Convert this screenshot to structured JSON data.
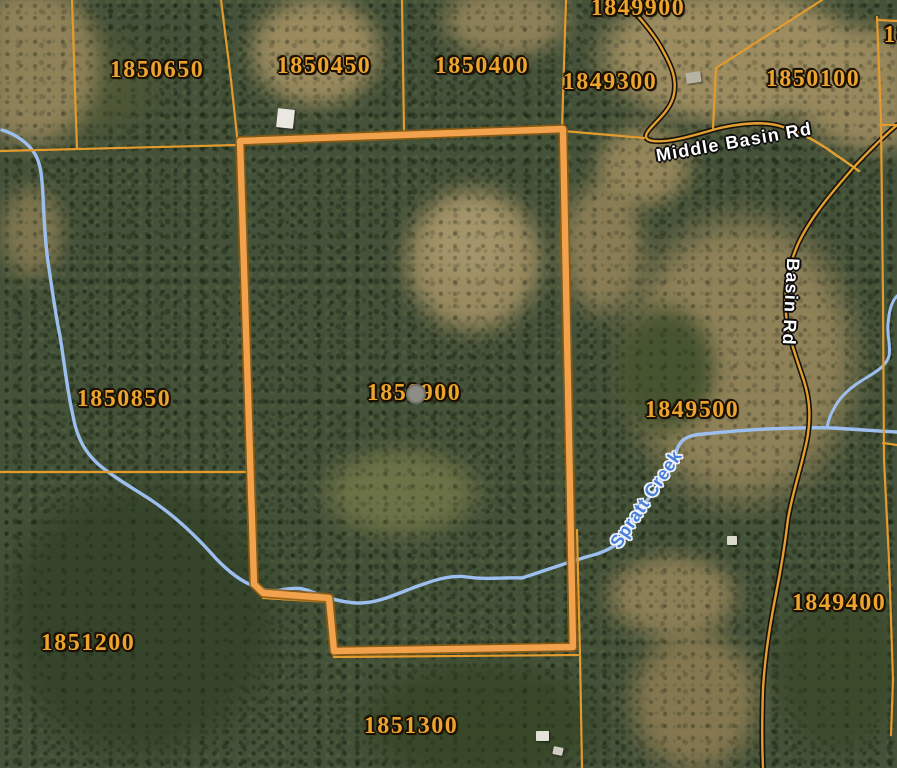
{
  "map": {
    "description": "County GIS parcel viewer - aerial imagery with parcel overlay",
    "selected_parcel_id": "1850900",
    "colors": {
      "parcel_line": "#e39b2d",
      "selected_outline": "#8d5d13",
      "selected_line": "#f2a14d",
      "road_casing": "#17130a",
      "road_center": "#e49f33",
      "creek": "#9dbff0",
      "parcel_text": "#eca42e",
      "road_text": "#ffffff",
      "creek_text": "#4a7fd8"
    },
    "selected_marker": {
      "x": 415,
      "y": 393,
      "r": 9
    },
    "parcel_labels": [
      {
        "text": "1849900",
        "x": 638,
        "y": 8
      },
      {
        "text": "1850650",
        "x": 157,
        "y": 70
      },
      {
        "text": "1850450",
        "x": 324,
        "y": 66
      },
      {
        "text": "1850400",
        "x": 482,
        "y": 66
      },
      {
        "text": "1849300",
        "x": 610,
        "y": 82
      },
      {
        "text": "1850100",
        "x": 813,
        "y": 79
      },
      {
        "text": "18",
        "x": 897,
        "y": 35
      },
      {
        "text": "1850850",
        "x": 124,
        "y": 399
      },
      {
        "text": "1850900",
        "x": 414,
        "y": 393
      },
      {
        "text": "1849500",
        "x": 692,
        "y": 410
      },
      {
        "text": "1849400",
        "x": 839,
        "y": 603
      },
      {
        "text": "1851200",
        "x": 88,
        "y": 643
      },
      {
        "text": "1851300",
        "x": 411,
        "y": 726
      }
    ],
    "road_labels": [
      {
        "text": "Middle Basin Rd",
        "x": 734,
        "y": 142,
        "rotate": -10
      },
      {
        "text": "Basin Rd",
        "x": 791,
        "y": 302,
        "rotate": 93
      }
    ],
    "water_labels": [
      {
        "text": "Spratt Creek",
        "x": 646,
        "y": 499,
        "rotate": -56
      }
    ],
    "structures": [
      {
        "x": 277,
        "y": 109,
        "w": 17,
        "h": 19,
        "rotate": 6,
        "color": "#e9e7df"
      },
      {
        "x": 686,
        "y": 72,
        "w": 15,
        "h": 11,
        "rotate": -8,
        "color": "#b8b2a2"
      },
      {
        "x": 536,
        "y": 731,
        "w": 13,
        "h": 10,
        "rotate": 0,
        "color": "#e4e2d8"
      },
      {
        "x": 553,
        "y": 747,
        "w": 10,
        "h": 8,
        "rotate": 12,
        "color": "#cfccc0"
      },
      {
        "x": 727,
        "y": 536,
        "w": 10,
        "h": 9,
        "rotate": 0,
        "color": "#dcd9cd"
      }
    ],
    "vectors": [
      {
        "name": "creek-spratt-main",
        "stroke": "creek",
        "width": 3.4,
        "d": "M 2,130 C 16,134 29,144 35,154 C 41,164 42,178 43,196 C 44,220 45,240 48,262 C 52,288 55,312 60,336 C 64,360 67,390 73,416 C 77,438 85,452 98,464 C 112,476 131,487 151,500 C 172,514 191,531 211,553 C 224,568 238,579 249,584 C 259,589 270,592 281,590 C 293,588 301,587 312,592 C 327,598 341,602 356,603 C 380,604 402,591 421,585 C 437,579 452,575 467,577 C 487,580 506,577 522,578 C 537,573 549,569 561,565 C 573,561 585,557 597,554 C 608,550 618,545 622,538 C 627,530 633,516 642,507 C 652,494 661,482 668,472 C 673,464 675,455 678,447 C 682,438 690,435 703,434 C 723,432 744,430 766,429 C 790,428 813,427 832,428 C 852,429 876,431 897,432"
      },
      {
        "name": "creek-tributary",
        "stroke": "creek",
        "width": 3,
        "d": "M 897,296 C 891,302 889,312 888,324 C 887,337 891,346 889,356 C 886,366 877,371 866,378 C 852,386 842,395 836,405 C 831,413 828,420 827,428"
      },
      {
        "name": "road-middle-basin-casing",
        "stroke": "road_casing",
        "width": 5.6,
        "d": "M 628,5 C 641,19 654,34 662,49 C 671,65 677,78 674,94 C 671,110 657,120 649,130 C 644,136 645,140 653,141 C 668,143 692,136 716,129 C 741,123 766,121 783,127 C 790,129 797,132 803,135"
      },
      {
        "name": "road-basin-casing",
        "stroke": "road_casing",
        "width": 5.6,
        "d": "M 897,125 C 884,136 869,151 854,167 C 837,187 812,214 798,244 C 788,267 784,291 786,314 C 788,337 797,359 804,381 C 810,400 811,418 807,440 C 801,469 792,494 788,519 C 785,544 781,569 776,594 C 770,624 765,654 763,689 C 762,719 762,745 763,768"
      },
      {
        "name": "road-middle-basin-center",
        "stroke": "road_center",
        "width": 2.4,
        "d": "M 628,5 C 641,19 654,34 662,49 C 671,65 677,78 674,94 C 671,110 657,120 649,130 C 644,136 645,140 653,141 C 668,143 692,136 716,129 C 741,123 766,121 783,127 C 790,129 797,132 803,135 C 814,140 825,147 836,155 C 845,161 852,166 859,171"
      },
      {
        "name": "road-basin-center",
        "stroke": "road_center",
        "width": 2.4,
        "d": "M 897,125 C 884,136 869,151 854,167 C 837,187 812,214 798,244 C 788,267 784,291 786,314 C 788,337 797,359 804,381 C 810,400 811,418 807,440 C 801,469 792,494 788,519 C 785,544 781,569 776,594 C 770,624 765,654 763,689 C 762,719 762,745 763,768"
      },
      {
        "name": "parcel-line-west-horizontal",
        "stroke": "parcel_line",
        "width": 2.2,
        "d": "M 0,151 L 238,145"
      },
      {
        "name": "parcel-line-nw-vertical-1",
        "stroke": "parcel_line",
        "width": 2.2,
        "d": "M 72,0 L 77,149"
      },
      {
        "name": "parcel-line-nw-vertical-2",
        "stroke": "parcel_line",
        "width": 2.2,
        "d": "M 221,0 L 231,80 L 238,145"
      },
      {
        "name": "parcel-line-1850450-east",
        "stroke": "parcel_line",
        "width": 2.2,
        "d": "M 402,0 L 404,130"
      },
      {
        "name": "parcel-line-1850400-east",
        "stroke": "parcel_line",
        "width": 2.2,
        "d": "M 566,0 L 562,129"
      },
      {
        "name": "parcel-line-1849300-south",
        "stroke": "parcel_line",
        "width": 2.2,
        "d": "M 563,131 L 610,135 L 644,138"
      },
      {
        "name": "parcel-line-1849300-east",
        "stroke": "parcel_line",
        "width": 2.2,
        "d": "M 822,0 L 760,40 L 716,68 L 713,128"
      },
      {
        "name": "parcel-line-east-vertical",
        "stroke": "parcel_line",
        "width": 2.2,
        "d": "M 877,17 L 881,120 L 883,300 L 884,460 L 889,560 L 893,680 L 891,735"
      },
      {
        "name": "parcel-line-ne-stub-1",
        "stroke": "parcel_line",
        "width": 2.2,
        "d": "M 877,20 L 897,21"
      },
      {
        "name": "parcel-line-ne-stub-2",
        "stroke": "parcel_line",
        "width": 2.2,
        "d": "M 880,125 L 897,125"
      },
      {
        "name": "parcel-line-1850850-south",
        "stroke": "parcel_line",
        "width": 2.2,
        "d": "M 0,472 L 246,472"
      },
      {
        "name": "parcel-line-1851300-north",
        "stroke": "parcel_line",
        "width": 2.2,
        "d": "M 263,598 L 330,602 L 334,657 L 578,655"
      },
      {
        "name": "parcel-line-1851300-east",
        "stroke": "parcel_line",
        "width": 2.2,
        "d": "M 577,530 L 580,655 L 582,768"
      },
      {
        "name": "parcel-line-east-stub",
        "stroke": "parcel_line",
        "width": 2.2,
        "d": "M 883,443 L 897,445"
      },
      {
        "name": "selected-parcel-boundary-outline",
        "stroke": "selected_outline",
        "width": 10,
        "opacity": 0.85,
        "d": "M 240,141 L 563,129 L 573,647 L 334,651 L 329,598 L 263,593 L 254,584 Z"
      },
      {
        "name": "selected-parcel-boundary",
        "stroke": "selected_line",
        "width": 6.4,
        "d": "M 240,141 L 563,129 L 573,647 L 334,651 L 329,598 L 263,593 L 254,584 Z"
      }
    ]
  }
}
